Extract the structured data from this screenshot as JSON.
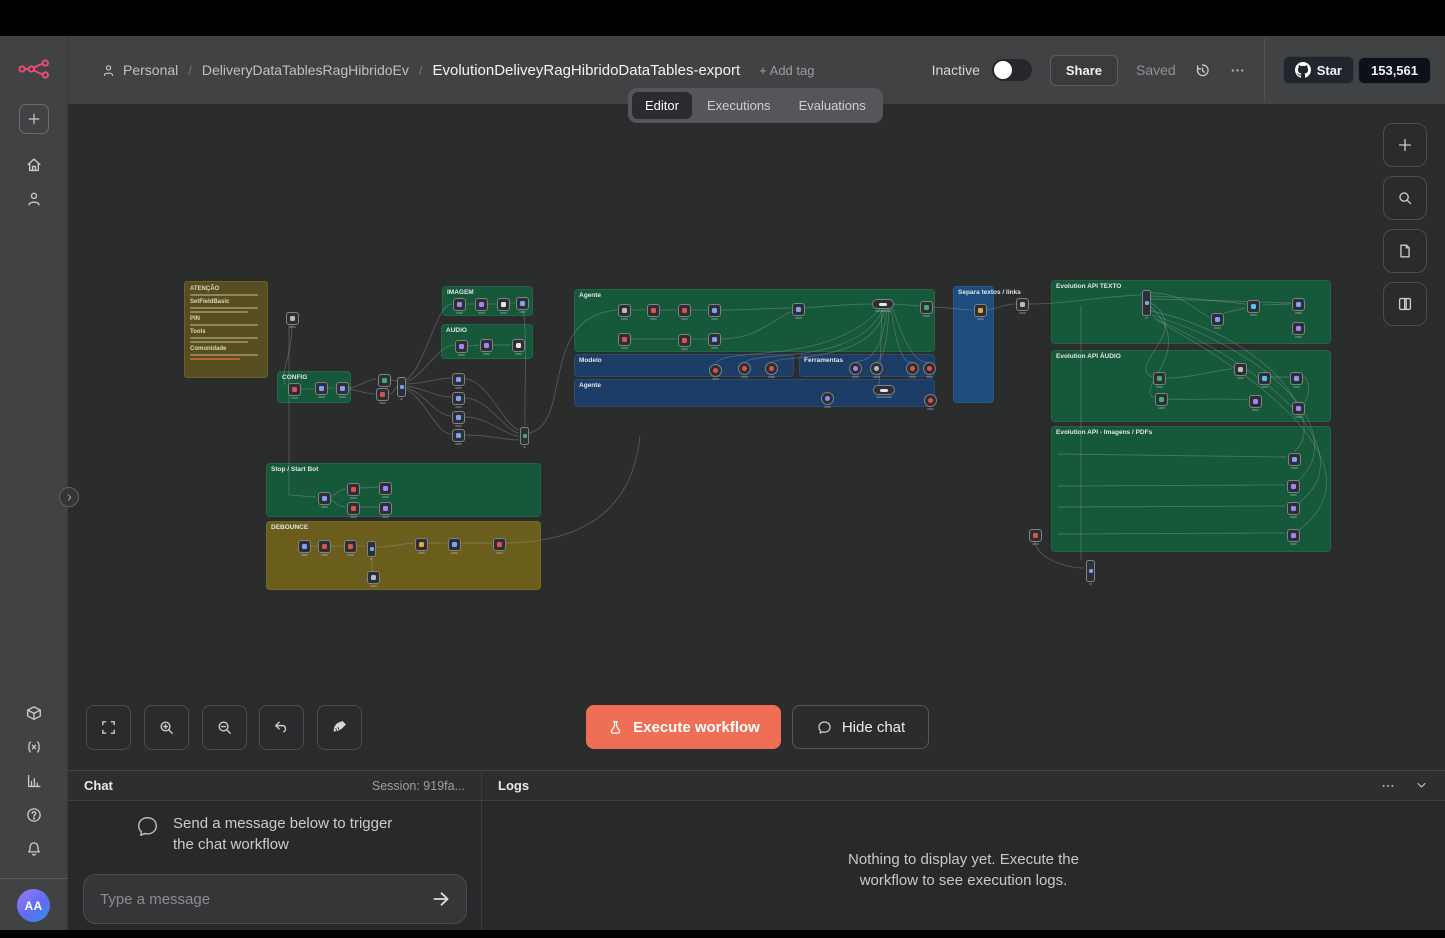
{
  "header": {
    "breadcrumb": {
      "personal": "Personal",
      "project": "DeliveryDataTablesRagHibridoEv",
      "workflow": "EvolutionDeliveyRagHibridoDataTables-export",
      "add_tag": "+ Add tag"
    },
    "inactive_label": "Inactive",
    "share_label": "Share",
    "saved_label": "Saved",
    "github": {
      "star_label": "Star",
      "count": "153,561"
    }
  },
  "tabs": [
    {
      "label": "Editor",
      "active": true
    },
    {
      "label": "Executions",
      "active": false
    },
    {
      "label": "Evaluations",
      "active": false
    }
  ],
  "sidebar": {
    "avatar_initials": "AA"
  },
  "toolbar": {
    "execute_label": "Execute workflow",
    "hide_chat_label": "Hide chat"
  },
  "chat": {
    "title": "Chat",
    "session": "Session: 919fa...",
    "empty_line1": "Send a message below to trigger",
    "empty_line2": "the chat workflow",
    "placeholder": "Type a message"
  },
  "logs": {
    "title": "Logs",
    "empty_line1": "Nothing to display yet. Execute the",
    "empty_line2": "workflow to see execution logs."
  },
  "colors": {
    "accent": "#ee6f55",
    "brand": "#ea4b71",
    "group_green": "#16583a",
    "group_blue": "#1c3e66",
    "group_blue_bright": "#1e4c7c",
    "sticky_olive": "#564e20",
    "group_olive": "#6b5d1b"
  },
  "canvas": {
    "sticky": {
      "x": 116,
      "y": 245,
      "w": 84,
      "h": 97,
      "headings": [
        {
          "t": "ATENÇÃO",
          "lines": 1
        },
        {
          "t": "SetFieldBasic",
          "lines": 2
        },
        {
          "t": "PIN",
          "lines": 1
        },
        {
          "t": "Tools",
          "lines": 2
        },
        {
          "t": "Comunidade",
          "lines": 1
        }
      ],
      "has_link": true
    },
    "groups": [
      {
        "label": "CONFIG",
        "x": 209,
        "y": 335,
        "w": 74,
        "h": 32,
        "c": "#16583a"
      },
      {
        "label": "IMAGEM",
        "x": 374,
        "y": 250,
        "w": 91,
        "h": 30,
        "c": "#16583a"
      },
      {
        "label": "AUDIO",
        "x": 373,
        "y": 288,
        "w": 92,
        "h": 35,
        "c": "#16583a"
      },
      {
        "label": "Agente",
        "x": 506,
        "y": 253,
        "w": 361,
        "h": 63,
        "c": "#16583a"
      },
      {
        "label": "Modelo",
        "x": 506,
        "y": 318,
        "w": 220,
        "h": 23,
        "c": "#1c3e66"
      },
      {
        "label": "Ferramentas",
        "x": 731,
        "y": 318,
        "w": 136,
        "h": 23,
        "c": "#1c3e66"
      },
      {
        "label": "Agente",
        "x": 506,
        "y": 343,
        "w": 361,
        "h": 28,
        "c": "#1c3e66"
      },
      {
        "label": "Separa textos / links",
        "x": 885,
        "y": 250,
        "w": 41,
        "h": 117,
        "c": "#1e4c7c"
      },
      {
        "label": "Evolution API TEXTO",
        "x": 983,
        "y": 244,
        "w": 280,
        "h": 64,
        "c": "#16583a"
      },
      {
        "label": "Evolution API ÁUDIO",
        "x": 983,
        "y": 314,
        "w": 280,
        "h": 72,
        "c": "#16583a"
      },
      {
        "label": "Evolution API - Imagens / PDFs",
        "x": 983,
        "y": 390,
        "w": 280,
        "h": 126,
        "c": "#16583a"
      },
      {
        "label": "Stop / Start Bot",
        "x": 198,
        "y": 427,
        "w": 275,
        "h": 54,
        "c": "#16583a"
      },
      {
        "label": "DEBOUNCE",
        "x": 198,
        "y": 485,
        "w": 275,
        "h": 69,
        "c": "#6b5d1b"
      }
    ],
    "nodes": [
      {
        "x": 218,
        "y": 276,
        "c": "#b8bcc2"
      },
      {
        "x": 220,
        "y": 347,
        "c": "#d9534f"
      },
      {
        "x": 247,
        "y": 346,
        "c": "#7aa2f7"
      },
      {
        "x": 268,
        "y": 346,
        "c": "#7aa2f7"
      },
      {
        "x": 385,
        "y": 262,
        "c": "#9b87f5"
      },
      {
        "x": 407,
        "y": 262,
        "c": "#9b87f5"
      },
      {
        "x": 429,
        "y": 262,
        "c": "#e6e6e6"
      },
      {
        "x": 448,
        "y": 261,
        "c": "#7aa2f7"
      },
      {
        "x": 387,
        "y": 304,
        "c": "#9b87f5"
      },
      {
        "x": 412,
        "y": 303,
        "c": "#9b87f5"
      },
      {
        "x": 444,
        "y": 303,
        "c": "#e6e6e6"
      },
      {
        "x": 310,
        "y": 338,
        "c": "#3fae6a"
      },
      {
        "x": 308,
        "y": 352,
        "c": "#d9534f"
      },
      {
        "x": 329,
        "y": 341,
        "c": "#7aa2f7",
        "t": "tl",
        "h": 20
      },
      {
        "x": 384,
        "y": 337,
        "c": "#7aa2f7"
      },
      {
        "x": 384,
        "y": 356,
        "c": "#7aa2f7"
      },
      {
        "x": 384,
        "y": 375,
        "c": "#7aa2f7"
      },
      {
        "x": 384,
        "y": 393,
        "c": "#7aa2f7"
      },
      {
        "x": 452,
        "y": 391,
        "c": "#3fae6a",
        "t": "tl",
        "h": 18
      },
      {
        "x": 550,
        "y": 268,
        "c": "#b8bcc2"
      },
      {
        "x": 579,
        "y": 268,
        "c": "#d9534f"
      },
      {
        "x": 610,
        "y": 268,
        "c": "#d9534f"
      },
      {
        "x": 640,
        "y": 268,
        "c": "#7aa2f7"
      },
      {
        "x": 724,
        "y": 267,
        "c": "#7aa2f7"
      },
      {
        "x": 804,
        "y": 263,
        "c": "#e6e6e6",
        "t": "pl"
      },
      {
        "x": 852,
        "y": 265,
        "c": "#3fae6a"
      },
      {
        "x": 550,
        "y": 297,
        "c": "#d9534f"
      },
      {
        "x": 610,
        "y": 298,
        "c": "#d9534f"
      },
      {
        "x": 640,
        "y": 297,
        "c": "#7aa2f7"
      },
      {
        "x": 641,
        "y": 328,
        "c": "#d9534f",
        "t": "rd"
      },
      {
        "x": 670,
        "y": 326,
        "c": "#d9534f",
        "t": "rd"
      },
      {
        "x": 697,
        "y": 326,
        "c": "#d9534f",
        "t": "rd"
      },
      {
        "x": 781,
        "y": 326,
        "c": "#9b87f5",
        "t": "rd"
      },
      {
        "x": 802,
        "y": 326,
        "c": "#b8bcc2",
        "t": "rd"
      },
      {
        "x": 838,
        "y": 326,
        "c": "#d9534f",
        "t": "rd"
      },
      {
        "x": 855,
        "y": 326,
        "c": "#d9534f",
        "t": "rd"
      },
      {
        "x": 753,
        "y": 356,
        "c": "#9b87f5",
        "t": "rd"
      },
      {
        "x": 805,
        "y": 349,
        "c": "#e6e6e6",
        "t": "pl"
      },
      {
        "x": 856,
        "y": 358,
        "c": "#d9534f",
        "t": "rd"
      },
      {
        "x": 906,
        "y": 268,
        "c": "#e8a33d"
      },
      {
        "x": 948,
        "y": 262,
        "c": "#b8bcc2"
      },
      {
        "x": 1074,
        "y": 254,
        "c": "#7aa2f7",
        "t": "tl",
        "h": 26
      },
      {
        "x": 1143,
        "y": 277,
        "c": "#7aa2f7"
      },
      {
        "x": 1179,
        "y": 264,
        "c": "#4fc3f7"
      },
      {
        "x": 1224,
        "y": 262,
        "c": "#7aa2f7"
      },
      {
        "x": 1224,
        "y": 286,
        "c": "#9b87f5"
      },
      {
        "x": 1085,
        "y": 336,
        "c": "#3fae6a"
      },
      {
        "x": 1087,
        "y": 357,
        "c": "#3fae6a"
      },
      {
        "x": 1166,
        "y": 327,
        "c": "#b8bcc2"
      },
      {
        "x": 1181,
        "y": 359,
        "c": "#9b87f5"
      },
      {
        "x": 1190,
        "y": 336,
        "c": "#4fc3f7"
      },
      {
        "x": 1222,
        "y": 336,
        "c": "#7aa2f7"
      },
      {
        "x": 1224,
        "y": 366,
        "c": "#9b87f5"
      },
      {
        "x": 1220,
        "y": 417,
        "c": "#7aa2f7"
      },
      {
        "x": 1219,
        "y": 444,
        "c": "#9b87f5"
      },
      {
        "x": 1219,
        "y": 466,
        "c": "#9b87f5"
      },
      {
        "x": 1219,
        "y": 493,
        "c": "#9b87f5"
      },
      {
        "x": 961,
        "y": 493,
        "c": "#d9534f"
      },
      {
        "x": 1018,
        "y": 524,
        "c": "#7aa2f7",
        "t": "tl",
        "h": 22
      },
      {
        "x": 250,
        "y": 456,
        "c": "#7aa2f7"
      },
      {
        "x": 279,
        "y": 447,
        "c": "#d9534f"
      },
      {
        "x": 279,
        "y": 466,
        "c": "#d9534f"
      },
      {
        "x": 311,
        "y": 446,
        "c": "#9b87f5"
      },
      {
        "x": 311,
        "y": 466,
        "c": "#9b87f5"
      },
      {
        "x": 230,
        "y": 504,
        "c": "#7aa2f7"
      },
      {
        "x": 250,
        "y": 504,
        "c": "#d9534f"
      },
      {
        "x": 276,
        "y": 504,
        "c": "#d9534f"
      },
      {
        "x": 299,
        "y": 505,
        "c": "#7aa2f7",
        "t": "tl",
        "h": 16
      },
      {
        "x": 347,
        "y": 502,
        "c": "#e8a33d"
      },
      {
        "x": 380,
        "y": 502,
        "c": "#7aa2f7"
      },
      {
        "x": 425,
        "y": 502,
        "c": "#d9534f"
      },
      {
        "x": 299,
        "y": 535,
        "c": "#b8bcc2"
      }
    ],
    "edges": [
      "M224,289 C224,320 210,342 218,349",
      "M233,353 L246,353",
      "M260,352 L267,352",
      "M281,352 C293,350 300,343 308,343",
      "M281,353 C293,355 298,358 307,358",
      "M323,344 L329,345",
      "M321,358 C326,358 326,352 329,351",
      "M338,344 C358,330 368,268 384,268",
      "M338,346 C358,338 370,309 386,309",
      "M338,348 C356,348 368,342 383,342",
      "M338,350 C356,352 368,361 383,361",
      "M338,352 C356,356 368,380 383,380",
      "M338,354 C356,360 368,398 383,398",
      "M398,268 L406,268",
      "M420,268 L428,268",
      "M442,267 L447,267",
      "M400,310 L411,309",
      "M425,309 L443,309",
      "M455,274 C460,300 456,360 457,390",
      "M397,343 C420,344 436,390 451,394",
      "M397,362 C420,362 438,396 451,397",
      "M397,381 C420,381 438,400 451,400",
      "M397,399 C420,399 438,404 451,404",
      "M461,397 C505,388 470,280 549,274",
      "M563,274 L578,274",
      "M592,274 L609,274",
      "M623,274 L639,274",
      "M653,274 C685,274 700,272 723,272",
      "M737,272 C760,270 782,268 803,268",
      "M826,268 L851,270",
      "M865,271 C885,272 895,274 905,274",
      "M563,303 L609,303",
      "M623,303 L639,303",
      "M653,303 C690,303 706,282 723,276",
      "M812,273 C760,330 660,310 648,327",
      "M815,273 C790,330 685,314 676,327",
      "M817,273 C805,330 706,318 704,327",
      "M819,273 C812,335 788,322 787,327",
      "M821,273 C818,335 806,324 808,327",
      "M823,273 C832,335 842,324 844,327",
      "M825,273 C845,335 858,324 861,327",
      "M814,273 C812,330 812,340 811,349",
      "M918,274 C932,272 938,268 947,268",
      "M961,268 C1000,268 1035,260 1073,259",
      "M1083,257 C1110,256 1125,272 1142,282",
      "M1083,260 C1120,261 1155,266 1178,268",
      "M1083,263 C1130,264 1195,266 1223,267",
      "M1083,267 C1125,295 1058,328 1084,341",
      "M1083,271 C1130,315 1066,350 1086,362",
      "M1083,275 C1200,300 1262,385 1226,416",
      "M1084,279 C1215,320 1285,405 1225,449",
      "M1086,282 C1225,345 1295,425 1225,471",
      "M1088,284 C1235,365 1305,445 1225,498",
      "M1097,342 C1125,342 1148,334 1164,333",
      "M1099,363 C1130,364 1158,362 1180,364",
      "M1202,341 L1221,341",
      "M1235,341 C1242,341 1242,360 1237,366",
      "M1156,277 L1177,272",
      "M1195,269 L1222,268",
      "M990,418 L1218,421",
      "M990,450 L1217,449",
      "M990,471 L1217,470",
      "M990,498 L1217,497",
      "M1013,270 L1013,524",
      "M967,505 C967,520 995,532 1016,532",
      "M221,289 L221,459 L248,461",
      "M263,461 C268,458 272,453 278,453",
      "M263,463 C268,468 272,471 278,471",
      "M292,452 L310,451",
      "M292,471 L310,471",
      "M243,510 L249,510",
      "M263,510 L275,510",
      "M289,510 L297,510",
      "M309,511 C322,511 332,508 346,507",
      "M360,507 L379,507",
      "M393,507 L424,507",
      "M304,522 L304,536 L311,539",
      "M438,507 C520,506 565,470 572,400"
    ]
  }
}
